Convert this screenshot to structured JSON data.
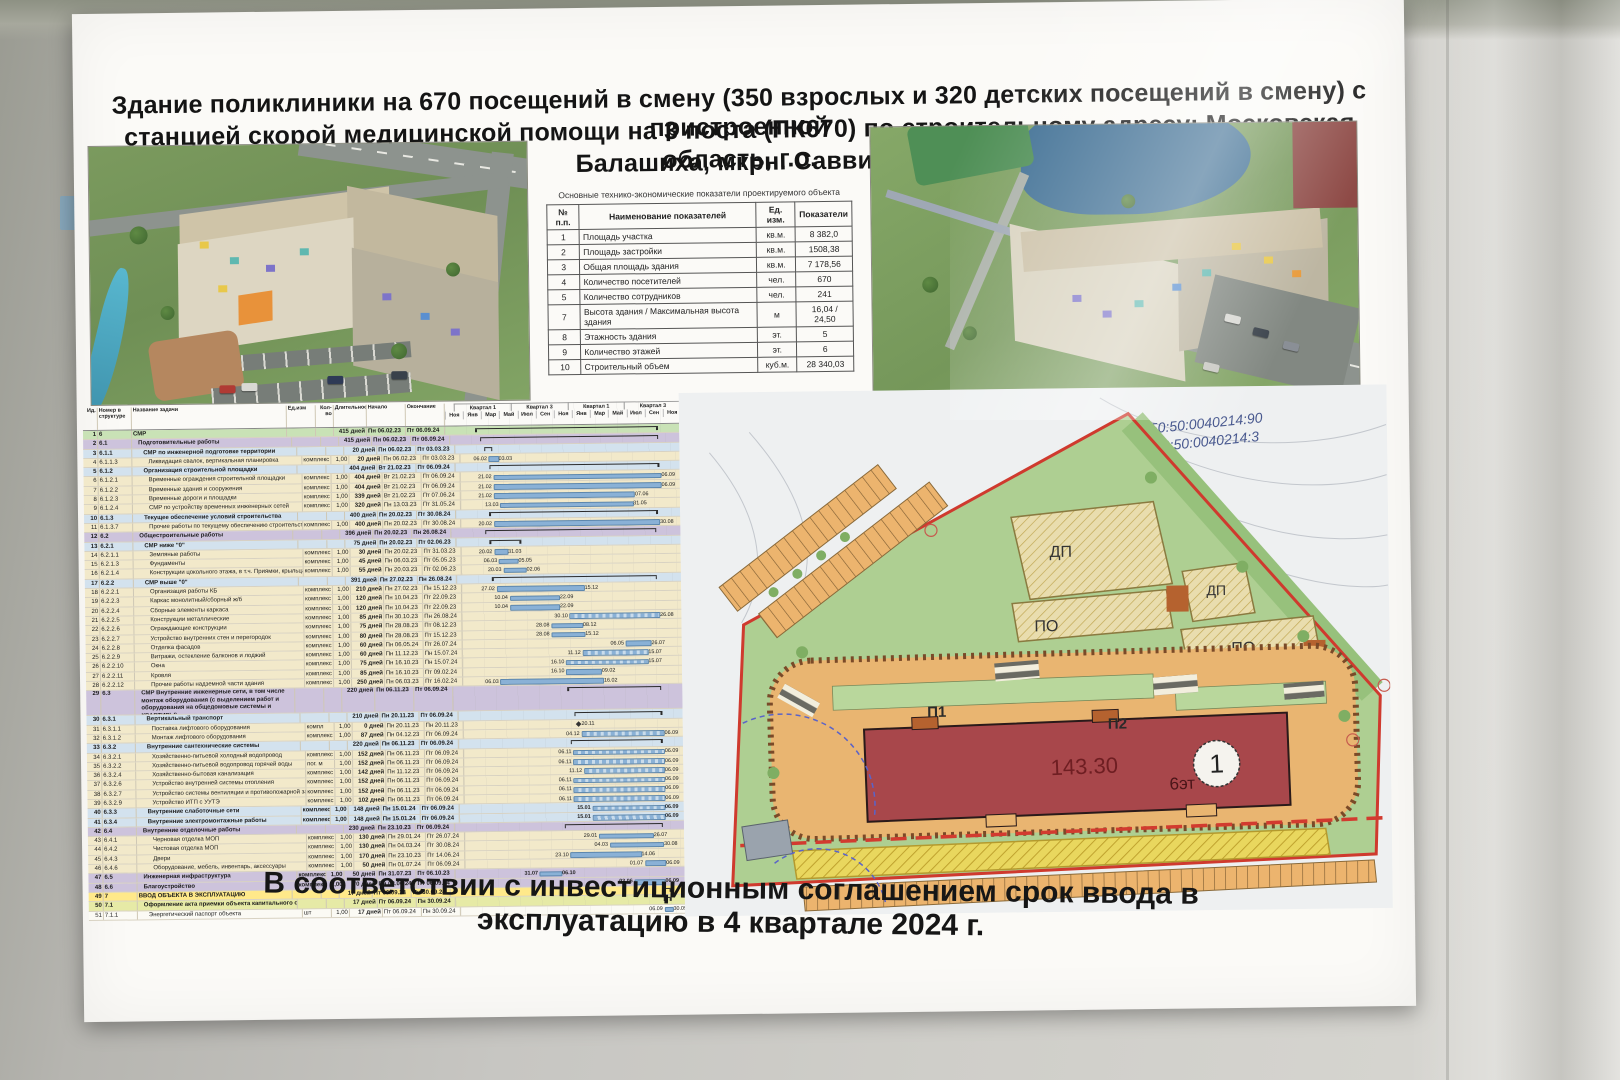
{
  "poster": {
    "title_line1": "Здание поликлиники на 670 посещений в смену (350 взрослых и 320 детских посещений в смену) с пристроенной",
    "title_line2": "станцией скорой медицинской помощи на 3 поста (ПК670) по строительному адресу: Московская область, г.о.",
    "title_line3": "Балашиха, мкрн. Саввино",
    "caption": "В соответствии с инвестиционным соглашением срок ввода в эксплуатацию в 4 квартале 2024 г."
  },
  "indicators_table": {
    "title": "Основные технико-экономические показатели проектируемого объекта",
    "headers": [
      "№ п.п.",
      "Наименование показателей",
      "Ед. изм.",
      "Показатели"
    ],
    "rows": [
      [
        "1",
        "Площадь участка",
        "кв.м.",
        "8 382,0"
      ],
      [
        "2",
        "Площадь застройки",
        "кв.м.",
        "1508,38"
      ],
      [
        "3",
        "Общая площадь здания",
        "кв.м.",
        "7 178,56"
      ],
      [
        "4",
        "Количество посетителей",
        "чел.",
        "670"
      ],
      [
        "5",
        "Количество сотрудников",
        "чел.",
        "241"
      ],
      [
        "7",
        "Высота здания / Максимальная высота здания",
        "м",
        "16,04 / 24,50"
      ],
      [
        "8",
        "Этажность здания",
        "эт.",
        "5"
      ],
      [
        "9",
        "Количество этажей",
        "эт.",
        "6"
      ],
      [
        "10",
        "Строительный объем",
        "куб.м.",
        "28 340,03"
      ]
    ]
  },
  "gantt": {
    "columns": [
      "Ид.",
      "Номер в структуре",
      "Название задачи",
      "Ед.изм",
      "Кол-во",
      "Длительность",
      "Начало",
      "Окончание"
    ],
    "quarters": [
      "Квартал 1",
      "Квартал 3",
      "Квартал 1",
      "Квартал 3"
    ],
    "months": [
      "Ноя",
      "Янв",
      "Мар",
      "Май",
      "Июл",
      "Сен",
      "Ноя",
      "Янв",
      "Мар",
      "Май",
      "Июл",
      "Сен",
      "Ноя"
    ],
    "row_fields": [
      "id",
      "num",
      "name",
      "unit",
      "qty",
      "duration",
      "start",
      "end",
      "band",
      "indent",
      "type",
      "dotted"
    ],
    "rows": [
      [
        1,
        "6",
        "СМР",
        "",
        "",
        "415 дней",
        "Пн 06.02.23",
        "Пт 06.09.24",
        "green",
        0,
        "s",
        0
      ],
      [
        2,
        "6.1",
        "Подготовительные работы",
        "",
        "",
        "415 дней",
        "Пн 06.02.23",
        "Пт 06.09.24",
        "lav",
        1,
        "s",
        0
      ],
      [
        3,
        "6.1.1",
        "СМР по инженерной подготовке территории",
        "",
        "",
        "20 дней",
        "Пн 06.02.23",
        "Пт 03.03.23",
        "blue",
        2,
        "s",
        0
      ],
      [
        4,
        "6.1.1.3",
        "Ликвидация свалок, вертикальная планировка",
        "комплекс",
        "1,00",
        "20 дней",
        "Пн 06.02.23",
        "Пт 03.03.23",
        "cream",
        3,
        "t",
        0
      ],
      [
        5,
        "6.1.2",
        "Организация строительной площадки",
        "",
        "",
        "404 дней",
        "Вт 21.02.23",
        "Пт 06.09.24",
        "blue",
        2,
        "s",
        0
      ],
      [
        6,
        "6.1.2.1",
        "Временные ограждения строительной площадки",
        "комплекс",
        "1,00",
        "404 дней",
        "Вт 21.02.23",
        "Пт 06.09.24",
        "cream",
        3,
        "t",
        0
      ],
      [
        7,
        "6.1.2.2",
        "Временные здания и сооружения",
        "комплекс",
        "1,00",
        "404 дней",
        "Вт 21.02.23",
        "Пт 06.09.24",
        "cream",
        3,
        "t",
        0
      ],
      [
        8,
        "6.1.2.3",
        "Временные дороги и площадки",
        "комплекс",
        "1,00",
        "339 дней",
        "Вт 21.02.23",
        "Пт 07.06.24",
        "cream",
        3,
        "t",
        0
      ],
      [
        9,
        "6.1.2.4",
        "СМР по устройству временных инженерных сетей",
        "комплекс",
        "1,00",
        "320 дней",
        "Пн 13.03.23",
        "Пт 31.05.24",
        "cream",
        3,
        "t",
        0
      ],
      [
        10,
        "6.1.3",
        "Текущее обеспечение условий строительства",
        "",
        "",
        "400 дней",
        "Пн 20.02.23",
        "Пт 30.08.24",
        "blue",
        2,
        "s",
        0
      ],
      [
        11,
        "6.1.3.7",
        "Прочие работы по текущему обеспечению строительства",
        "комплекс",
        "1,00",
        "400 дней",
        "Пн 20.02.23",
        "Пт 30.08.24",
        "cream",
        3,
        "t",
        0
      ],
      [
        12,
        "6.2",
        "Общестроительные работы",
        "",
        "",
        "396 дней",
        "Пн 20.02.23",
        "Пн 26.08.24",
        "lav",
        1,
        "s",
        0
      ],
      [
        13,
        "6.2.1",
        "СМР ниже \"0\"",
        "",
        "",
        "75 дней",
        "Пн 20.02.23",
        "Пт 02.06.23",
        "blue",
        2,
        "s",
        0
      ],
      [
        14,
        "6.2.1.1",
        "Земляные работы",
        "комплекс",
        "1,00",
        "30 дней",
        "Пн 20.02.23",
        "Пт 31.03.23",
        "cream",
        3,
        "t",
        0
      ],
      [
        15,
        "6.2.1.3",
        "Фундаменты",
        "комплекс",
        "1,00",
        "45 дней",
        "Пн 06.03.23",
        "Пт 05.05.23",
        "cream",
        3,
        "t",
        0
      ],
      [
        16,
        "6.2.1.4",
        "Конструкции цокольного этажа, в т.ч. Приямки, крыльца, пандусы и съезды",
        "комплекс",
        "1,00",
        "55 дней",
        "Пн 20.03.23",
        "Пт 02.06.23",
        "cream",
        3,
        "t",
        0
      ],
      [
        17,
        "6.2.2",
        "СМР выше \"0\"",
        "",
        "",
        "391 дней",
        "Пн 27.02.23",
        "Пн 26.08.24",
        "blue",
        2,
        "s",
        0
      ],
      [
        18,
        "6.2.2.1",
        "Организация работы КБ",
        "комплекс",
        "1,00",
        "210 дней",
        "Пн 27.02.23",
        "Пн 15.12.23",
        "cream",
        3,
        "t",
        0
      ],
      [
        19,
        "6.2.2.3",
        "Каркас монолитный/сборный ж/б",
        "комплекс",
        "1,00",
        "120 дней",
        "Пн 10.04.23",
        "Пт 22.09.23",
        "cream",
        3,
        "t",
        0
      ],
      [
        20,
        "6.2.2.4",
        "Сборные элементы каркаса",
        "комплекс",
        "1,00",
        "120 дней",
        "Пн 10.04.23",
        "Пт 22.09.23",
        "cream",
        3,
        "t",
        0
      ],
      [
        21,
        "6.2.2.5",
        "Конструкции металлические",
        "комплекс",
        "1,00",
        "85 дней",
        "Пн 30.10.23",
        "Пн 26.08.24",
        "cream",
        3,
        "t",
        1
      ],
      [
        22,
        "6.2.2.6",
        "Ограждающие конструкции",
        "комплекс",
        "1,00",
        "75 дней",
        "Пн 28.08.23",
        "Пт 08.12.23",
        "cream",
        3,
        "t",
        0
      ],
      [
        23,
        "6.2.2.7",
        "Устройство внутренних стен и перегородок",
        "комплекс",
        "1,00",
        "80 дней",
        "Пн 28.08.23",
        "Пт 15.12.23",
        "cream",
        3,
        "t",
        0
      ],
      [
        24,
        "6.2.2.8",
        "Отделка фасадов",
        "комплекс",
        "1,00",
        "60 дней",
        "Пн 06.05.24",
        "Пт 26.07.24",
        "cream",
        3,
        "t",
        0
      ],
      [
        25,
        "6.2.2.9",
        "Витражи, остекление балконов и лоджий",
        "комплекс",
        "1,00",
        "60 дней",
        "Пн 11.12.23",
        "Пн 15.07.24",
        "cream",
        3,
        "t",
        1
      ],
      [
        26,
        "6.2.2.10",
        "Окна",
        "комплекс",
        "1,00",
        "75 дней",
        "Пн 16.10.23",
        "Пн 15.07.24",
        "cream",
        3,
        "t",
        1
      ],
      [
        27,
        "6.2.2.11",
        "Кровля",
        "комплекс",
        "1,00",
        "85 дней",
        "Пн 16.10.23",
        "Пт 09.02.24",
        "cream",
        3,
        "t",
        0
      ],
      [
        28,
        "6.2.2.12",
        "Прочие работы надземной части здания",
        "комплекс",
        "1,00",
        "250 дней",
        "Пн 06.03.23",
        "Пт 16.02.24",
        "cream",
        3,
        "t",
        0
      ],
      [
        29,
        "6.3",
        "СМР Внутренние инженерные сети, в том числе монтаж оборудования (с выделением работ и оборудования на общедомовые системы и КВАРТИРЫ)",
        "",
        "",
        "220 дней",
        "Пн 06.11.23",
        "Пт 06.09.24",
        "lav",
        1,
        "s",
        0
      ],
      [
        30,
        "6.3.1",
        "Вертикальный транспорт",
        "",
        "",
        "210 дней",
        "Пн 20.11.23",
        "Пт 06.09.24",
        "blue",
        2,
        "s",
        0
      ],
      [
        31,
        "6.3.1.1",
        "Поставка лифтового оборудования",
        "компл",
        "1,00",
        "0 дней",
        "Пн 20.11.23",
        "Пн 20.11.23",
        "cream",
        3,
        "m",
        0
      ],
      [
        32,
        "6.3.1.2",
        "Монтаж лифтового оборудования",
        "комплекс",
        "1,00",
        "87 дней",
        "Пн 04.12.23",
        "Пт 06.09.24",
        "cream",
        3,
        "t",
        1
      ],
      [
        33,
        "6.3.2",
        "Внутренние сантехнические системы",
        "",
        "",
        "220 дней",
        "Пн 06.11.23",
        "Пт 06.09.24",
        "blue",
        2,
        "s",
        0
      ],
      [
        34,
        "6.3.2.1",
        "Хозяйственно-питьевой холодный водопровод",
        "комплекс",
        "1,00",
        "152 дней",
        "Пн 06.11.23",
        "Пт 06.09.24",
        "cream",
        3,
        "t",
        1
      ],
      [
        35,
        "6.3.2.2",
        "Хозяйственно-питьевой водопровод горячей воды",
        "пог. м",
        "1,00",
        "152 дней",
        "Пн 06.11.23",
        "Пт 06.09.24",
        "cream",
        3,
        "t",
        1
      ],
      [
        36,
        "6.3.2.4",
        "Хозяйственно-бытовая канализация",
        "комплекс",
        "1,00",
        "142 дней",
        "Пн 11.12.23",
        "Пт 06.09.24",
        "cream",
        3,
        "t",
        1
      ],
      [
        37,
        "6.3.2.6",
        "Устройство внутренней системы отопления",
        "комплекс",
        "1,00",
        "152 дней",
        "Пн 06.11.23",
        "Пт 06.09.24",
        "cream",
        3,
        "t",
        1
      ],
      [
        38,
        "6.3.2.7",
        "Устройство системы вентиляции и противопожарной защиты",
        "комплекс",
        "1,00",
        "152 дней",
        "Пн 06.11.23",
        "Пт 06.09.24",
        "cream",
        3,
        "t",
        1
      ],
      [
        39,
        "6.3.2.9",
        "Устройство ИТП с УУТЭ",
        "комплекс",
        "1,00",
        "102 дней",
        "Пн 06.11.23",
        "Пт 06.09.24",
        "cream",
        3,
        "t",
        1
      ],
      [
        40,
        "6.3.3",
        "Внутренние слаботочные сети",
        "комплекс",
        "1,00",
        "148 дней",
        "Пн 15.01.24",
        "Пт 06.09.24",
        "blue",
        2,
        "t",
        1
      ],
      [
        41,
        "6.3.4",
        "Внутренние электромонтажные работы",
        "комплекс",
        "1,00",
        "148 дней",
        "Пн 15.01.24",
        "Пт 06.09.24",
        "blue",
        2,
        "t",
        1
      ],
      [
        42,
        "6.4",
        "Внутренние отделочные работы",
        "",
        "",
        "230 дней",
        "Пн 23.10.23",
        "Пт 06.09.24",
        "lav",
        1,
        "s",
        0
      ],
      [
        43,
        "6.4.1",
        "Черновая отделка МОП",
        "комплекс",
        "1,00",
        "130 дней",
        "Пн 29.01.24",
        "Пт 26.07.24",
        "cream",
        3,
        "t",
        0
      ],
      [
        44,
        "6.4.2",
        "Чистовая отделка МОП",
        "комплекс",
        "1,00",
        "130 дней",
        "Пн 04.03.24",
        "Пт 30.08.24",
        "cream",
        3,
        "t",
        0
      ],
      [
        45,
        "6.4.3",
        "Двери",
        "комплекс",
        "1,00",
        "170 дней",
        "Пн 23.10.23",
        "Пт 14.06.24",
        "cream",
        3,
        "t",
        0
      ],
      [
        46,
        "6.4.6",
        "Оборудование, мебель, инвентарь, аксессуары",
        "комплекс",
        "1,00",
        "50 дней",
        "Пн 01.07.24",
        "Пт 06.09.24",
        "cream",
        3,
        "t",
        0
      ],
      [
        47,
        "6.5",
        "Инженерная инфраструктура",
        "комплекс",
        "1,00",
        "50 дней",
        "Пн 31.07.23",
        "Пт 06.10.23",
        "lav",
        1,
        "t",
        0
      ],
      [
        48,
        "6.6",
        "Благоустройство",
        "комплекс",
        "1,00",
        "70 дней",
        "Пн 03.06.24",
        "Пт 06.09.24",
        "lav",
        1,
        "t",
        0
      ],
      [
        49,
        "7",
        "ВВОД ОБЪЕКТА В ЭКСПЛУАТАЦИЮ",
        "",
        "",
        "17 дней",
        "Пт 06.09.24",
        "Пн 30.09.24",
        "yellow",
        0,
        "s",
        0
      ],
      [
        50,
        "7.1",
        "Оформление акта приемки объекта капитального строительства",
        "",
        "",
        "17 дней",
        "Пт 06.09.24",
        "Пн 30.09.24",
        "ygreen",
        1,
        "s",
        0
      ],
      [
        51,
        "7.1.1",
        "Энергетический паспорт объекта",
        "шт",
        "1,00",
        "17 дней",
        "Пт 06.09.24",
        "Пн 30.09.24",
        "white",
        2,
        "t",
        0
      ]
    ]
  },
  "site_plan": {
    "cadastral_1": "50:50:0040214:90",
    "cadastral_2": "50:50:0040214:3",
    "playground_children": "ДП",
    "playground_rest": "ПО",
    "entrance_1": "П1",
    "entrance_2": "П2",
    "building_area": "143.30",
    "building_floors": "6эт",
    "building_number": "1"
  },
  "colors": {
    "building_footprint": "#a8474b",
    "boundary_red": "#cf3a2e",
    "lawn_green": "#aecf92",
    "paving_orange": "#e9b571",
    "gantt_bar_blue": "#8ab1d6"
  }
}
